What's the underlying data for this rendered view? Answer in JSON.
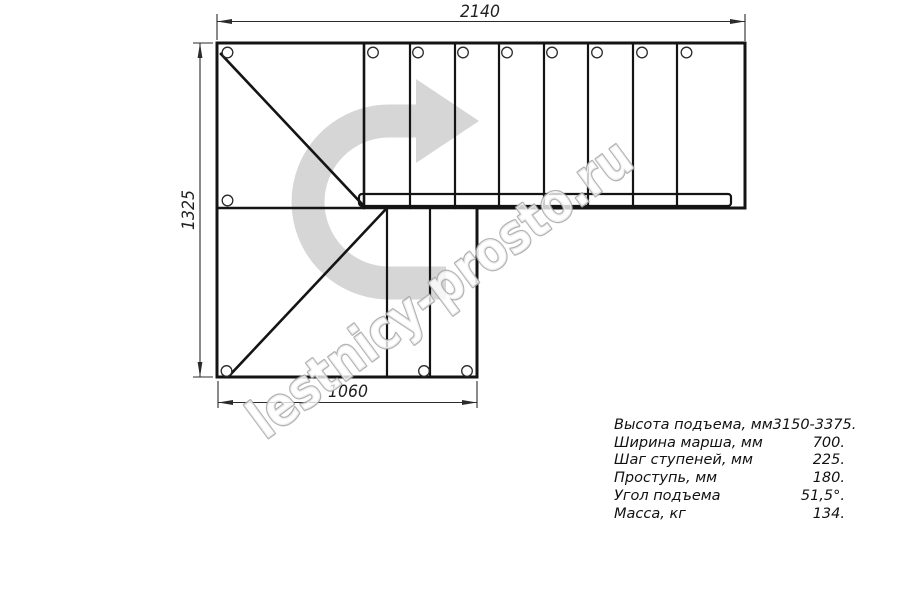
{
  "watermark": {
    "text": "lestnicy-prosto.ru"
  },
  "dimensions": {
    "top": {
      "value": "2140"
    },
    "left": {
      "value": "1325"
    },
    "bottom": {
      "value": "1060"
    }
  },
  "specs": {
    "rows": [
      {
        "label": "Высота подъема, мм",
        "value": "3150-3375."
      },
      {
        "label": "Ширина марша, мм",
        "value": "700."
      },
      {
        "label": "Шаг ступеней, мм",
        "value": "225."
      },
      {
        "label": "Проступь, мм",
        "value": "180."
      },
      {
        "label": "Угол подъема",
        "value": "51,5°."
      },
      {
        "label": "Масса, кг",
        "value": "134."
      }
    ]
  },
  "icons": {
    "direction_arrow": "u-turn-right-arrow"
  },
  "colors": {
    "outline": "#141414",
    "dimension": "#2b2b2b",
    "arrow_fill": "#d6d6d6",
    "watermark_stroke": "#a6a6a6"
  }
}
